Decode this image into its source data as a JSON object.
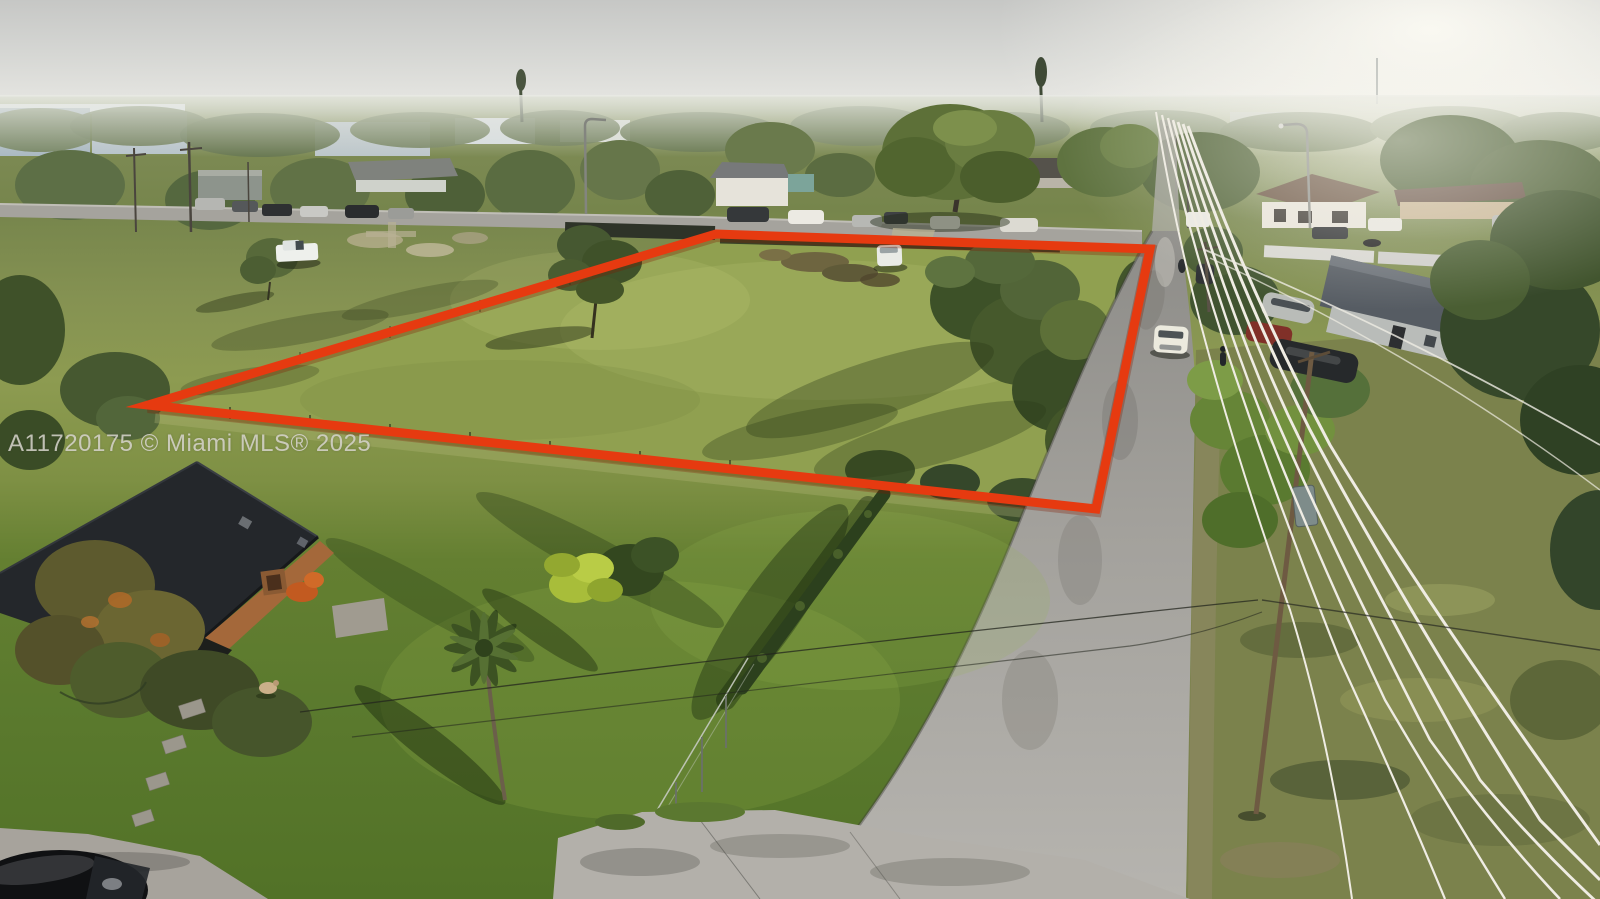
{
  "meta": {
    "description": "Aerial drone photograph of a vacant residential land parcel outlined in red, suburban Miami neighborhood, late-afternoon light"
  },
  "watermark": {
    "text": "A11720175 © Miami MLS® 2025"
  },
  "colors": {
    "boundary_red": "#e63a10",
    "sky_gray": "#d6d7d4",
    "sun_glare": "#faf8f1",
    "lot_grass_green": "#90a050",
    "lawn_green": "#5c7c2f",
    "road_asphalt": "#a3a19c",
    "house_roof_dark": "#24272b",
    "house_wall_orange": "#a4683a",
    "power_wire_white": "#efece3"
  },
  "scene_objects": [
    "red-boundary-outline",
    "vacant-lot",
    "white-suv-inside-lot",
    "white-pickup-truck",
    "neighborhood-street",
    "parked-cars",
    "side-road",
    "power-pole",
    "power-lines",
    "street-lamp",
    "big-tree",
    "pine-tree",
    "palm-tree",
    "banana-plant",
    "hedge",
    "chain-link-fence",
    "house-bottom-left",
    "gray-roof-house",
    "carport",
    "driveway",
    "black-car",
    "dog",
    "stepping-stones",
    "distant-commercial-buildings",
    "watermark"
  ]
}
